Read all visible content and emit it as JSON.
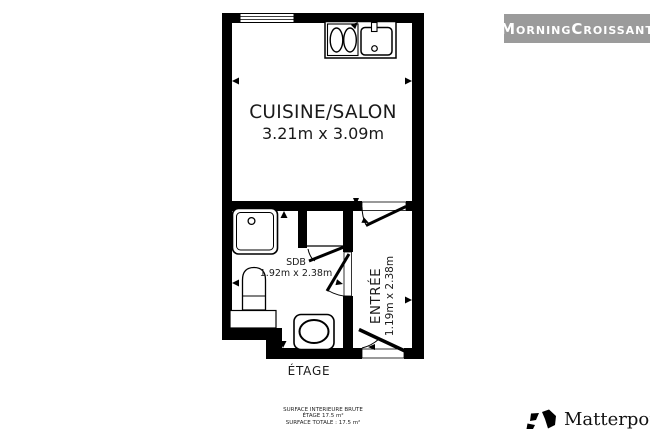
{
  "page": {
    "background": "#ffffff"
  },
  "branding": {
    "badge_label": "MorningCroissant",
    "badge_bg": "#9b9b9b",
    "badge_text_color": "#ffffff",
    "matterport_label": "Matterport",
    "matterport_reg": "®"
  },
  "floorplan": {
    "wall_color": "#000000",
    "floor_label": "ÉTAGE",
    "rooms": [
      {
        "name": "CUISINE/SALON",
        "dimensions": "3.21m x 3.09m"
      },
      {
        "name": "SDB",
        "dimensions": "1.92m x 2.38m"
      },
      {
        "name": "ENTRÉE",
        "dimensions": "1.19m x 2.38m"
      }
    ],
    "surface_summary": {
      "line1": "SURFACE INTERIEURE BRUTE",
      "line2": "ÉTAGE 17.5 m²",
      "line3": "SURFACE TOTALE : 17.5 m²"
    },
    "fixtures": [
      "window",
      "kitchen-counter",
      "stove",
      "sink",
      "shower",
      "washbasin",
      "toilet",
      "door-swing",
      "dimension-arrow"
    ]
  }
}
